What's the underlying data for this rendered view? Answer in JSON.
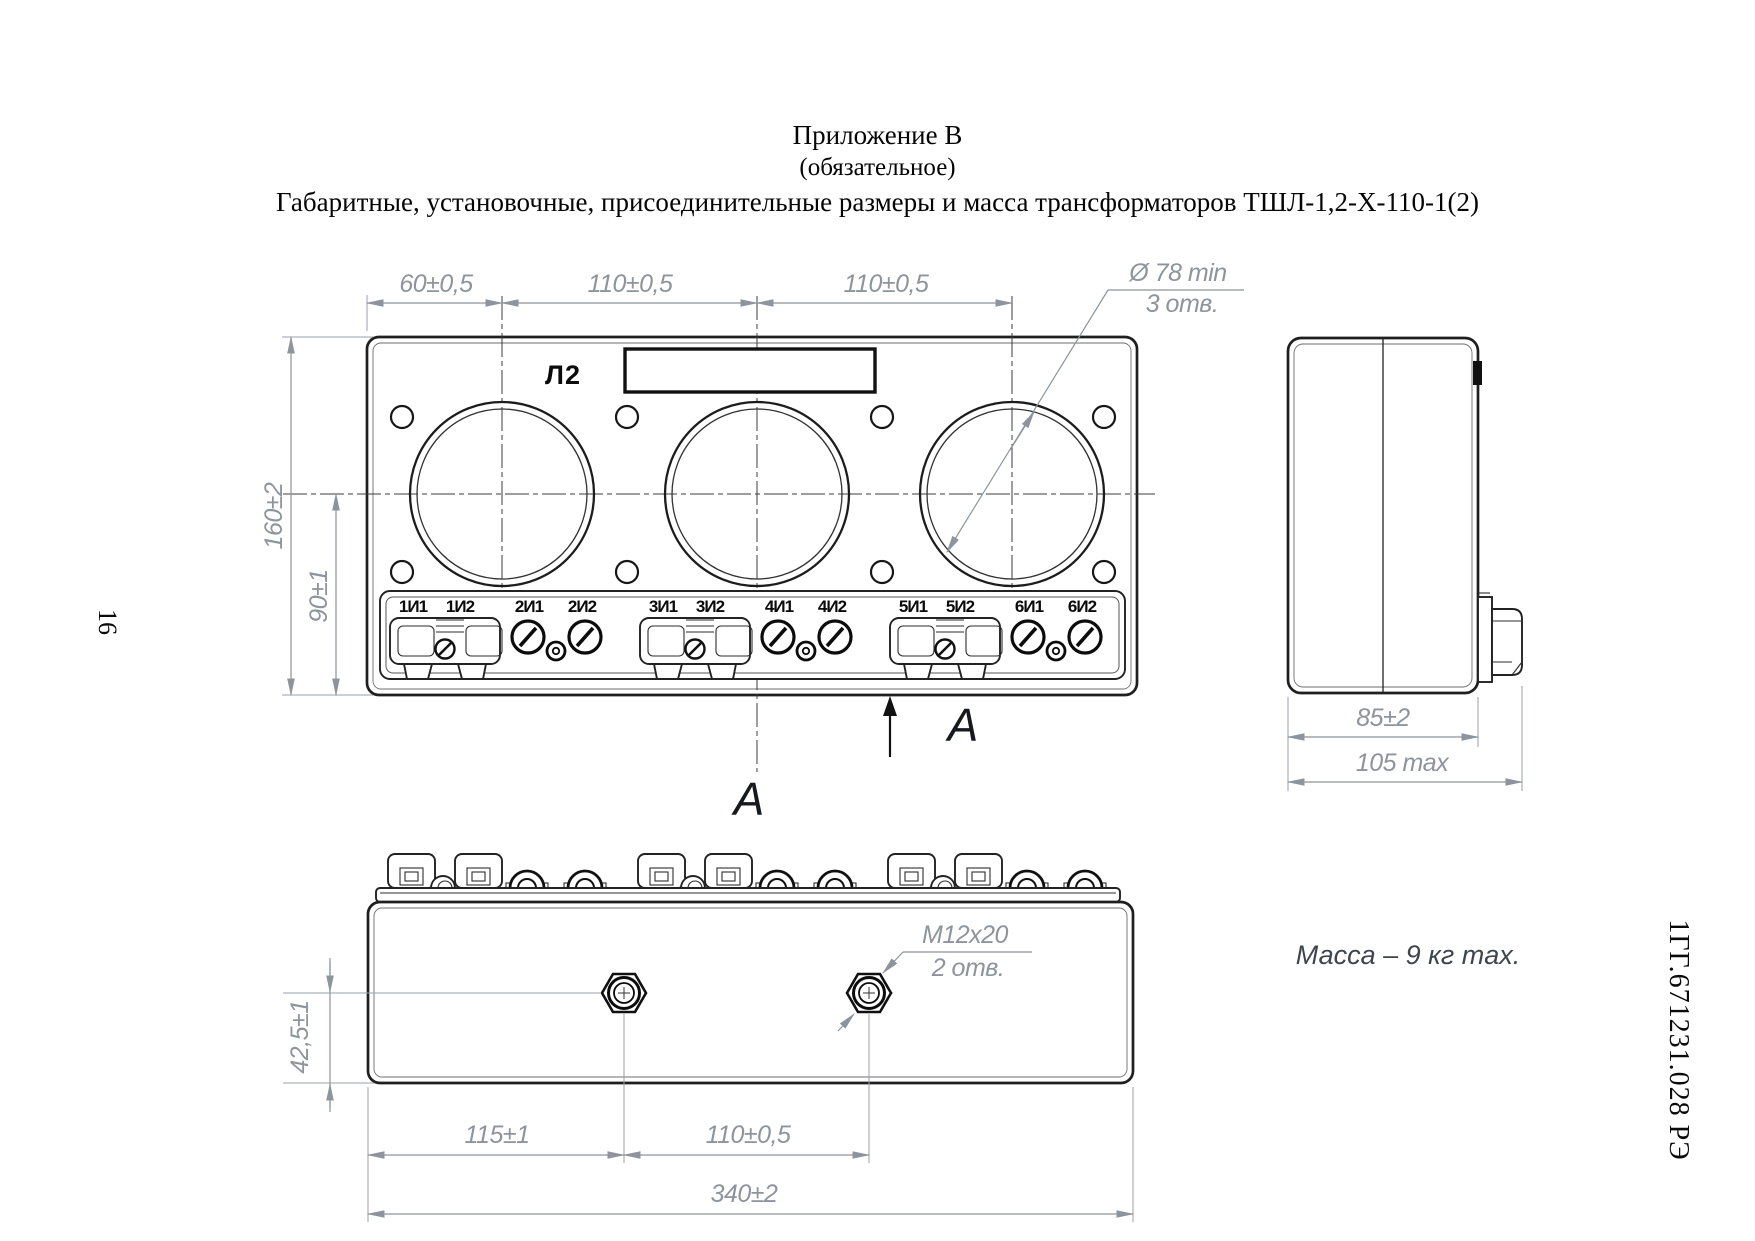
{
  "page": {
    "number": "16",
    "doc_code": "1ГГ.671231.028 РЭ"
  },
  "header": {
    "line1": "Приложение В",
    "line2": "(обязательное)",
    "line3": "Габаритные, установочные, присоединительные размеры и масса трансформаторов ТШЛ-1,2-Х-110-1(2)"
  },
  "front_view": {
    "marking_label": "Л2",
    "view_arrow_label": "А",
    "dims": {
      "top_left": "60±0,5",
      "top_mid": "110±0,5",
      "top_right": "110±0,5",
      "overall_height": "160±2",
      "terminal_offset": "90±1"
    },
    "hole_callout": {
      "diameter": "Ø 78 min",
      "count": "3 отв."
    },
    "terminals": [
      "1И1",
      "1И2",
      "2И1",
      "2И2",
      "3И1",
      "3И2",
      "4И1",
      "4И2",
      "5И1",
      "5И2",
      "6И1",
      "6И2"
    ]
  },
  "side_view": {
    "dims": {
      "body_width": "85±2",
      "overall_width": "105 max"
    }
  },
  "bottom_view": {
    "view_label": "А",
    "thread_callout": {
      "thread": "M12x20",
      "count": "2 отв."
    },
    "dims": {
      "insert_offset": "42,5±1",
      "edge_to_insert": "115±1",
      "insert_spacing": "110±0,5",
      "overall_length": "340±2"
    }
  },
  "notes": {
    "mass": "Масса – 9 кг max."
  },
  "colors": {
    "line": "#1f1f1f",
    "dimension": "#8d949c"
  }
}
